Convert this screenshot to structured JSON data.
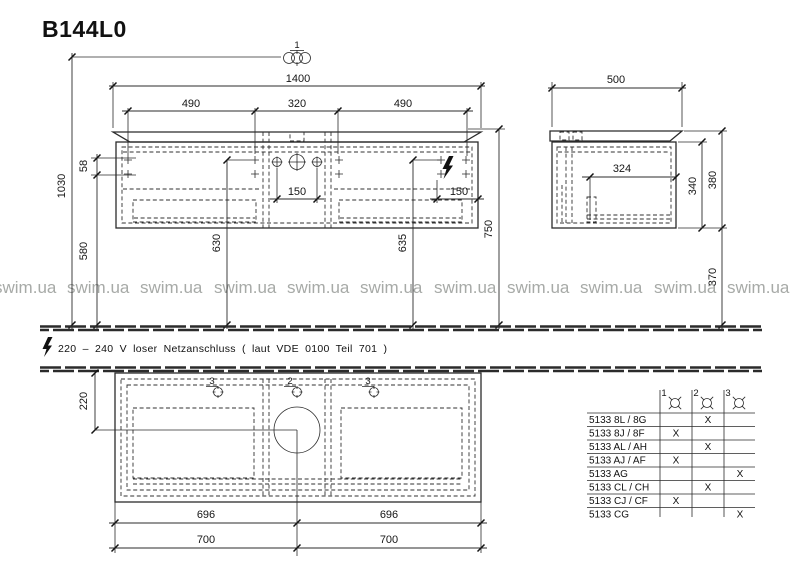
{
  "title": "B144L0",
  "watermark": "swim.ua",
  "note": {
    "text": "220 – 240 V loser Netzanschluss ( laut VDE 0100 Teil 701 )"
  },
  "front_view": {
    "callout": "1",
    "dim_total_width": "1400",
    "dim_left_basin": "490",
    "dim_center": "320",
    "dim_right_basin": "490",
    "dim_tap_height": "1030",
    "dim_tap_to_top": "58",
    "dim_under_cabinet": "580",
    "dim_left_drain_height": "630",
    "dim_right_drain_height": "635",
    "dim_top_height": "750",
    "dim_tap_span_left": "150",
    "dim_tap_span_right": "150"
  },
  "side_view": {
    "dim_depth": "500",
    "dim_inner_depth": "324",
    "dim_body_height": "340",
    "dim_total_height": "380",
    "dim_floor_clearance": "370"
  },
  "plan_view": {
    "callout_left": "3",
    "callout_center": "2",
    "callout_right": "3",
    "dim_drain_offset": "220",
    "dim_inner_left": "696",
    "dim_inner_right": "696",
    "dim_half_left": "700",
    "dim_half_right": "700"
  },
  "table": {
    "columns": [
      "1",
      "2",
      "3"
    ],
    "rows": [
      {
        "label": "5133 8L / 8G",
        "marks": [
          "",
          "X",
          ""
        ]
      },
      {
        "label": "5133 8J / 8F",
        "marks": [
          "X",
          "",
          ""
        ]
      },
      {
        "label": "5133 AL / AH",
        "marks": [
          "",
          "X",
          ""
        ]
      },
      {
        "label": "5133 AJ / AF",
        "marks": [
          "X",
          "",
          ""
        ]
      },
      {
        "label": "5133 AG",
        "marks": [
          "",
          "",
          "X"
        ]
      },
      {
        "label": "5133 CL / CH",
        "marks": [
          "",
          "X",
          ""
        ]
      },
      {
        "label": "5133 CJ / CF",
        "marks": [
          "X",
          "",
          ""
        ]
      },
      {
        "label": "5133 CG",
        "marks": [
          "",
          "",
          "X"
        ]
      }
    ]
  }
}
